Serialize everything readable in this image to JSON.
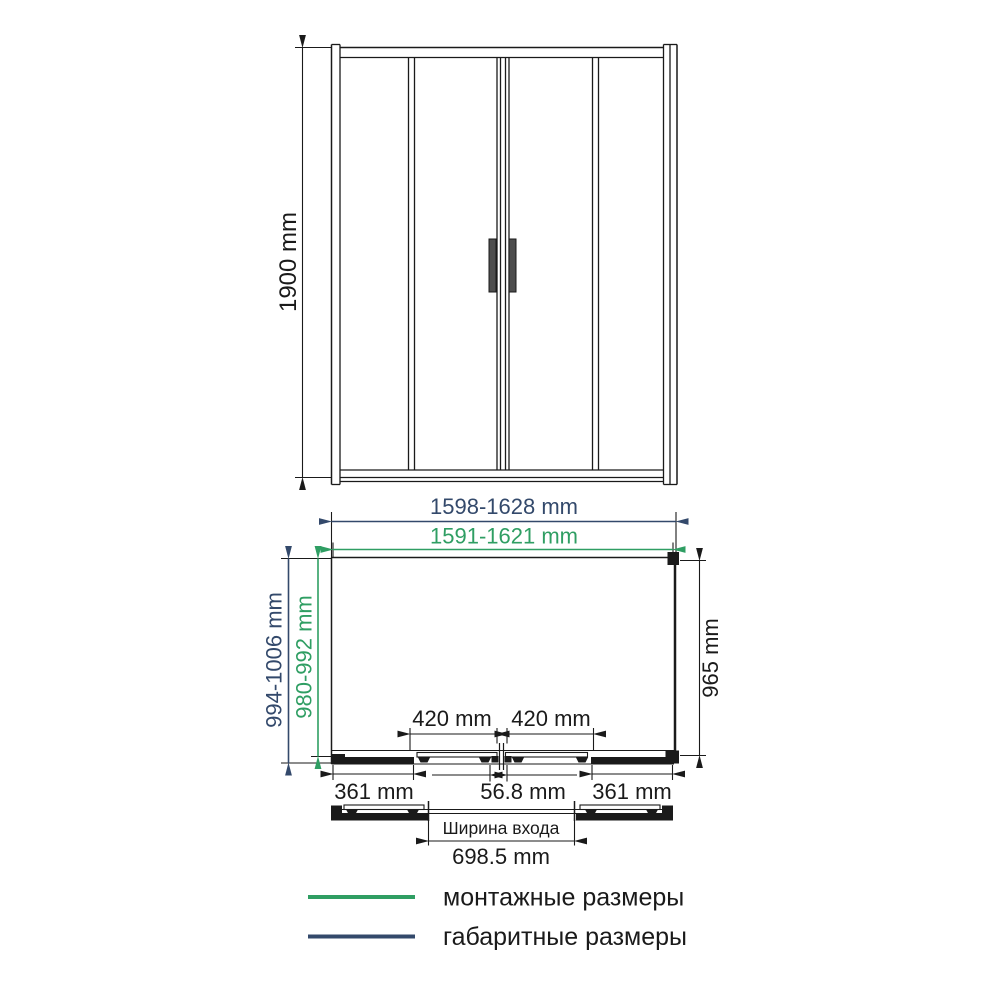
{
  "colors": {
    "mounting_green": "#2f9e63",
    "overall_navy": "#33496b",
    "ink": "#1a1a1a"
  },
  "front_view": {
    "height_label": "1900 mm"
  },
  "plan_view": {
    "overall_width_label": "1598-1628 mm",
    "mounting_width_label": "1591-1621 mm",
    "overall_depth_label": "994-1006 mm",
    "mounting_depth_label": "980-992 mm",
    "side_depth_label": "965 mm",
    "left_door_label": "420 mm",
    "right_door_label": "420 mm",
    "left_fixed_label": "361 mm",
    "center_gap_label": "56.8 mm",
    "right_fixed_label": "361 mm"
  },
  "entrance": {
    "caption": "Ширина входа",
    "width_label": "698.5 mm"
  },
  "legend": {
    "items": [
      {
        "label": "монтажные размеры",
        "color": "#2f9e63"
      },
      {
        "label": "габаритные размеры",
        "color": "#33496b"
      }
    ]
  }
}
